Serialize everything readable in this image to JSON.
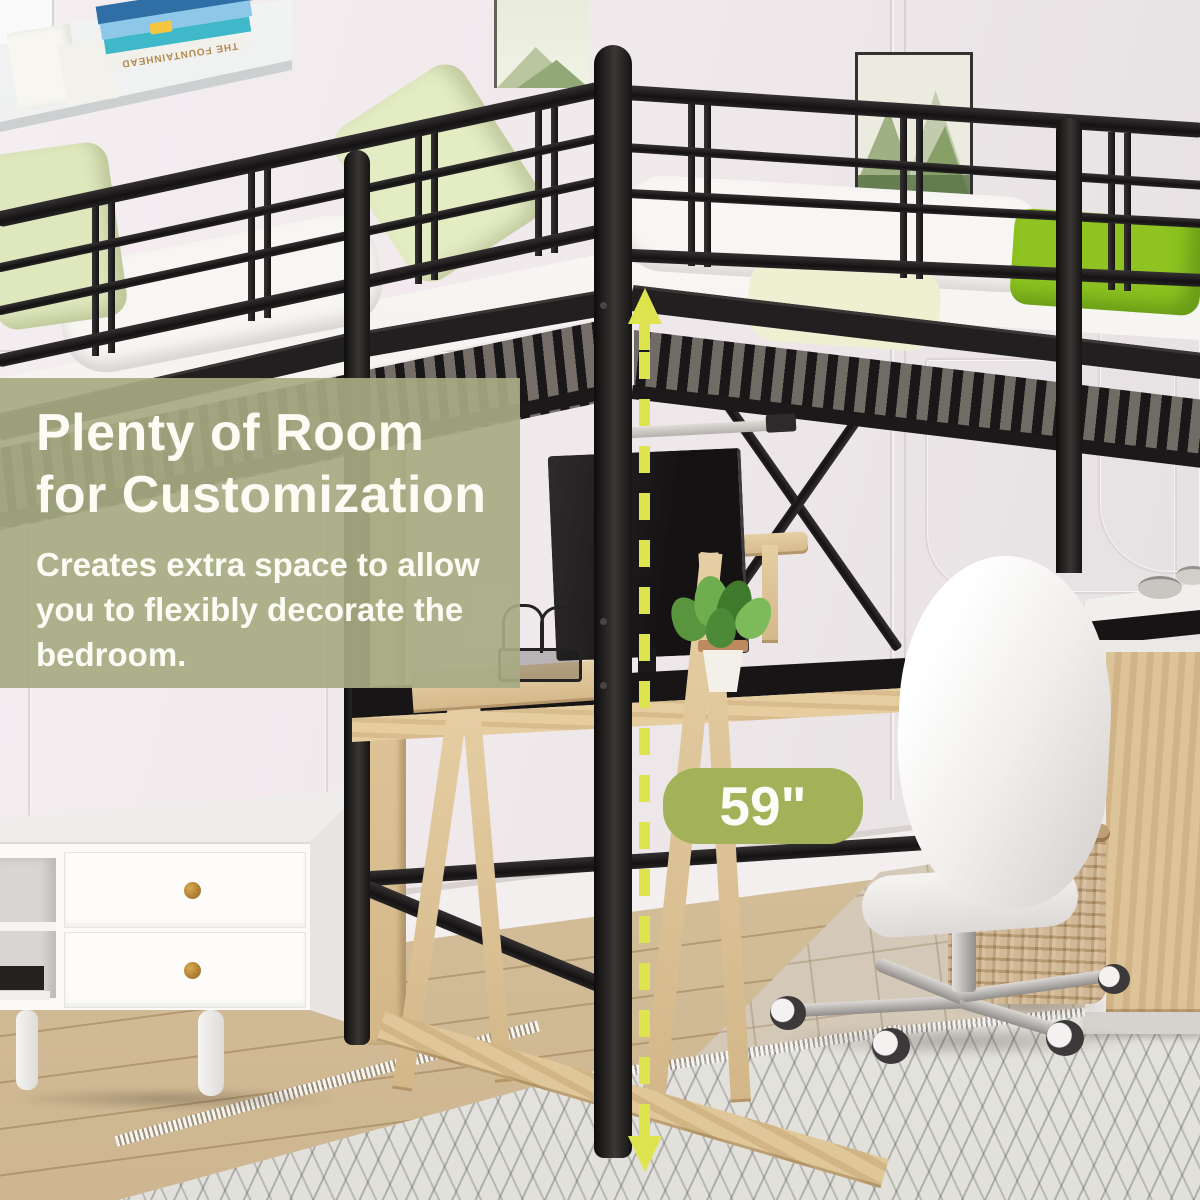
{
  "overlay": {
    "heading_line1": "Plenty of Room",
    "heading_line2": "for Customization",
    "body_line1": "Creates extra space to allow",
    "body_line2": "you to flexibly decorate the",
    "body_line3": "bedroom."
  },
  "dimension": {
    "label": "59\""
  },
  "shelf": {
    "book_title": "THE FOUNTAINHEAD"
  },
  "colors": {
    "wall": "#f2ebee",
    "panel": "rgba(166,171,130,0.92)",
    "heading": "#fcfcf4",
    "pill": "#a3b259",
    "pill_text": "#fdfdf8",
    "arrow": "#dee44e",
    "metal": "#201e1f",
    "wood": "#dcc49b",
    "wood_dark": "#c9ad83",
    "floor": "#d8c5a1",
    "rug": "#e9e7e2",
    "mattress": "#f8f6f3",
    "pillow": "#dfe8bd",
    "cushion": "#8ec321",
    "white_furniture": "#fbfaf9",
    "basket": "#c9ad85",
    "chrome": "#c6c3c0"
  }
}
